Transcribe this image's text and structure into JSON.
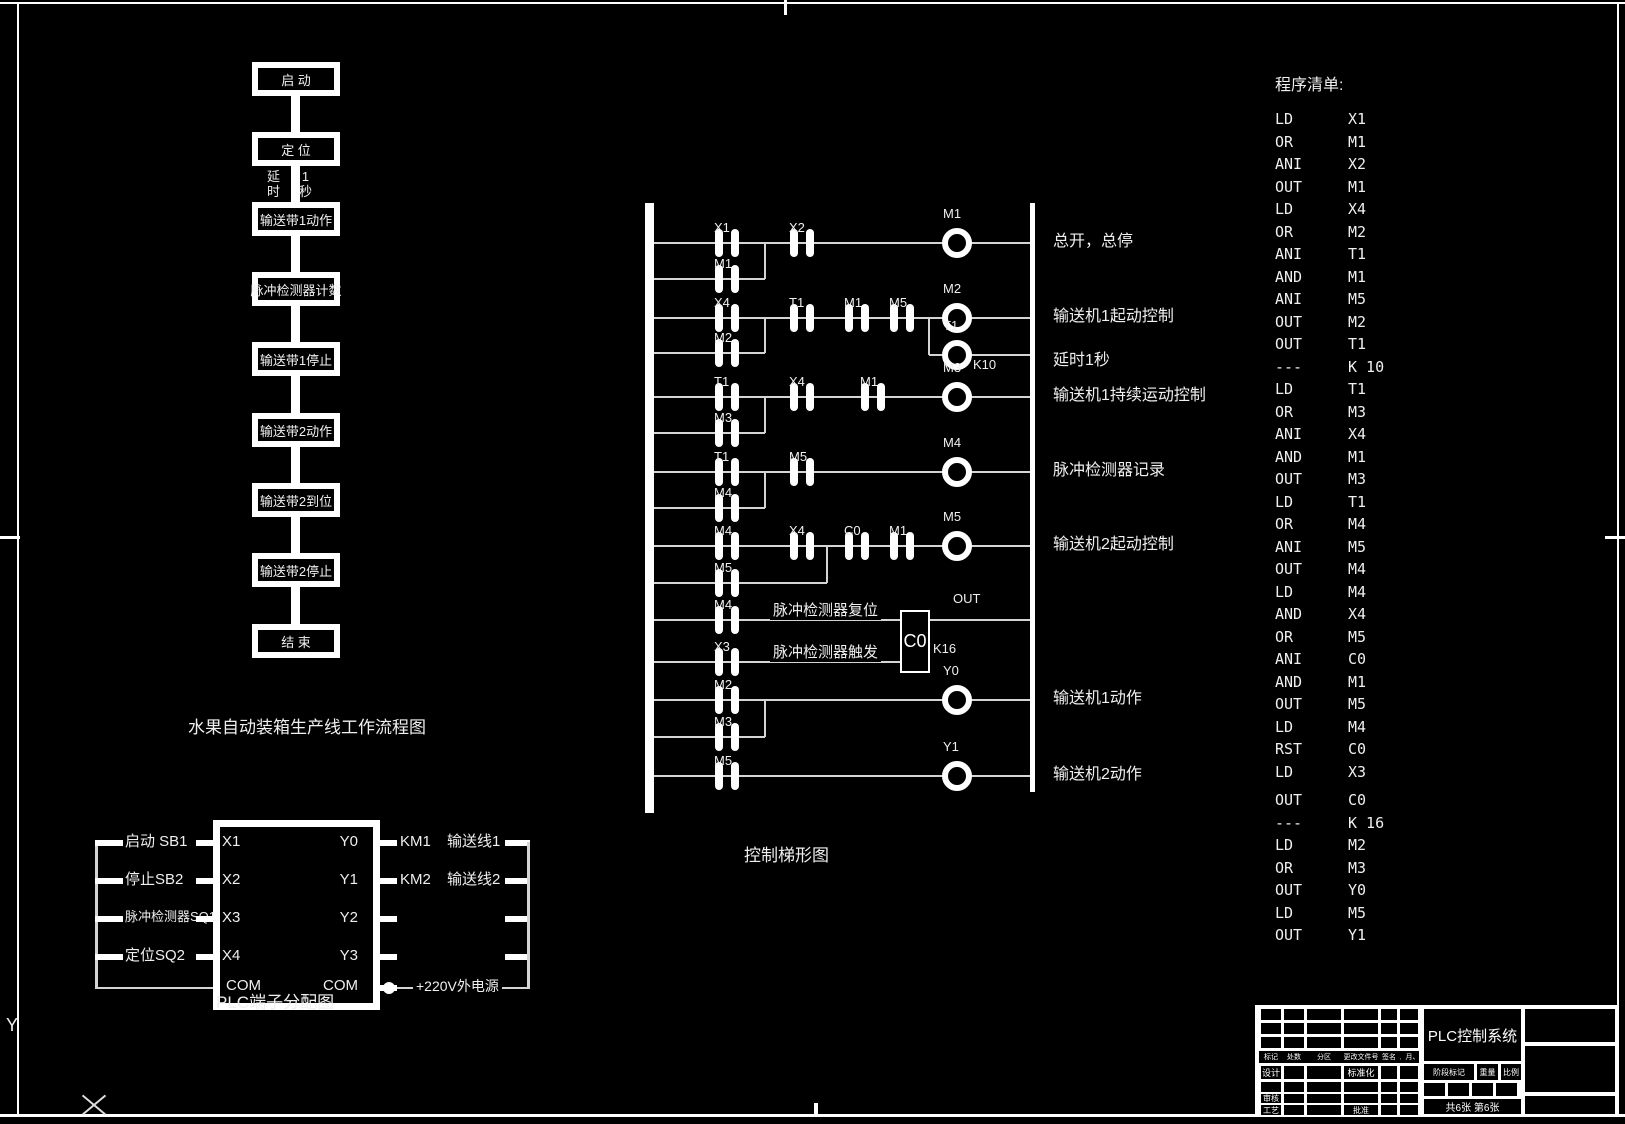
{
  "frame": {
    "y_axis_label": "Y"
  },
  "flowchart": {
    "caption": "水果自动装箱生产线工作流程图",
    "steps": [
      "启  动",
      "定  位",
      "输送带1动作",
      "脉冲检测器计数",
      "输送带1停止",
      "输送带2动作",
      "输送带2到位",
      "输送带2停止",
      "结  束"
    ],
    "delay_note_left": "延时",
    "delay_note_right": "1秒"
  },
  "ladder": {
    "caption": "控制梯形图",
    "rungs": [
      {
        "contacts": [
          "X1",
          "X2"
        ],
        "parallel": "M1",
        "coil": "M1",
        "comment": "总开，总停"
      },
      {
        "contacts": [
          "X4",
          "T1",
          "M1",
          "M5"
        ],
        "parallel": "M2",
        "coil": "M2",
        "comment": "输送机1起动控制",
        "branch": {
          "coil": "T1",
          "k": "K10",
          "comment": "延时1秒"
        }
      },
      {
        "contacts": [
          "T1",
          "X4",
          "M1"
        ],
        "parallel": "M3",
        "coil": "M3",
        "comment": "输送机1持续运动控制"
      },
      {
        "contacts": [
          "T1",
          "M5"
        ],
        "parallel": "M4",
        "coil": "M4",
        "comment": "脉冲检测器记录"
      },
      {
        "contacts": [
          "M4",
          "X4",
          "C0",
          "M1"
        ],
        "parallel": "M5",
        "coil": "M5",
        "comment": "输送机2起动控制"
      },
      {
        "contacts": [
          "M2"
        ],
        "parallel": "M3",
        "coil": "Y0",
        "comment": "输送机1动作"
      },
      {
        "contacts": [
          "M5"
        ],
        "coil": "Y1",
        "comment": "输送机2动作"
      }
    ],
    "counter": {
      "reset_contact": "M4",
      "trigger_contact": "X3",
      "reset_text": "脉冲检测器复位",
      "trigger_text": "脉冲检测器触发",
      "box_label": "C0",
      "k": "K16",
      "out": "OUT"
    }
  },
  "program": {
    "title": "程序清单:",
    "lines": [
      {
        "op": "LD",
        "arg": "X1"
      },
      {
        "op": "OR",
        "arg": "M1"
      },
      {
        "op": "ANI",
        "arg": "X2"
      },
      {
        "op": "OUT",
        "arg": "M1"
      },
      {
        "op": "LD",
        "arg": "X4"
      },
      {
        "op": "OR",
        "arg": "M2"
      },
      {
        "op": "ANI",
        "arg": "T1"
      },
      {
        "op": "AND",
        "arg": "M1"
      },
      {
        "op": "ANI",
        "arg": "M5"
      },
      {
        "op": "OUT",
        "arg": "M2"
      },
      {
        "op": "OUT",
        "arg": "T1"
      },
      {
        "op": "---",
        "arg": "K 10"
      },
      {
        "op": "LD",
        "arg": "T1"
      },
      {
        "op": "OR",
        "arg": "M3"
      },
      {
        "op": "ANI",
        "arg": "X4"
      },
      {
        "op": "AND",
        "arg": "M1"
      },
      {
        "op": "OUT",
        "arg": "M3"
      },
      {
        "op": "LD",
        "arg": "T1"
      },
      {
        "op": "OR",
        "arg": "M4"
      },
      {
        "op": "ANI",
        "arg": "M5"
      },
      {
        "op": "OUT",
        "arg": "M4"
      },
      {
        "op": "LD",
        "arg": "M4"
      },
      {
        "op": "AND",
        "arg": "X4"
      },
      {
        "op": "OR",
        "arg": "M5"
      },
      {
        "op": "ANI",
        "arg": "C0"
      },
      {
        "op": "AND",
        "arg": "M1"
      },
      {
        "op": "OUT",
        "arg": "M5"
      },
      {
        "op": "LD",
        "arg": "M4"
      },
      {
        "op": "RST",
        "arg": "C0"
      },
      {
        "op": "LD",
        "arg": "X3"
      },
      {
        "op": "OUT",
        "arg": "C0"
      },
      {
        "op": "---",
        "arg": "K 16"
      },
      {
        "op": "LD",
        "arg": "M2"
      },
      {
        "op": "OR",
        "arg": "M3"
      },
      {
        "op": "OUT",
        "arg": "Y0"
      },
      {
        "op": "LD",
        "arg": "M5"
      },
      {
        "op": "OUT",
        "arg": "Y1"
      }
    ]
  },
  "terminal": {
    "caption": "PLC端子分配图",
    "inputs": [
      {
        "label": "启动 SB1",
        "pin": "X1"
      },
      {
        "label": "停止SB2",
        "pin": "X2"
      },
      {
        "label": "脉冲检测器SQ1",
        "pin": "X3"
      },
      {
        "label": "定位SQ2",
        "pin": "X4"
      }
    ],
    "outputs": [
      {
        "pin": "Y0",
        "label": "KM1",
        "line": "输送线1"
      },
      {
        "pin": "Y1",
        "label": "KM2",
        "line": "输送线2"
      },
      {
        "pin": "Y2",
        "label": "",
        "line": ""
      },
      {
        "pin": "Y3",
        "label": "",
        "line": ""
      }
    ],
    "com_left": "COM",
    "com_right": "COM",
    "power": "+220V外电源"
  },
  "title_block": {
    "title": "PLC控制系统",
    "row_marks": [
      "标记",
      "处数",
      "分区",
      "更改文件号",
      "签名",
      "年、月、日"
    ],
    "design": "设计",
    "standardization": "标准化",
    "review": "审核",
    "process": "工艺",
    "approve": "批准",
    "stage_mark": "阶段标记",
    "weight": "重量",
    "scale": "比例",
    "sheets": "共6张 第6张"
  }
}
